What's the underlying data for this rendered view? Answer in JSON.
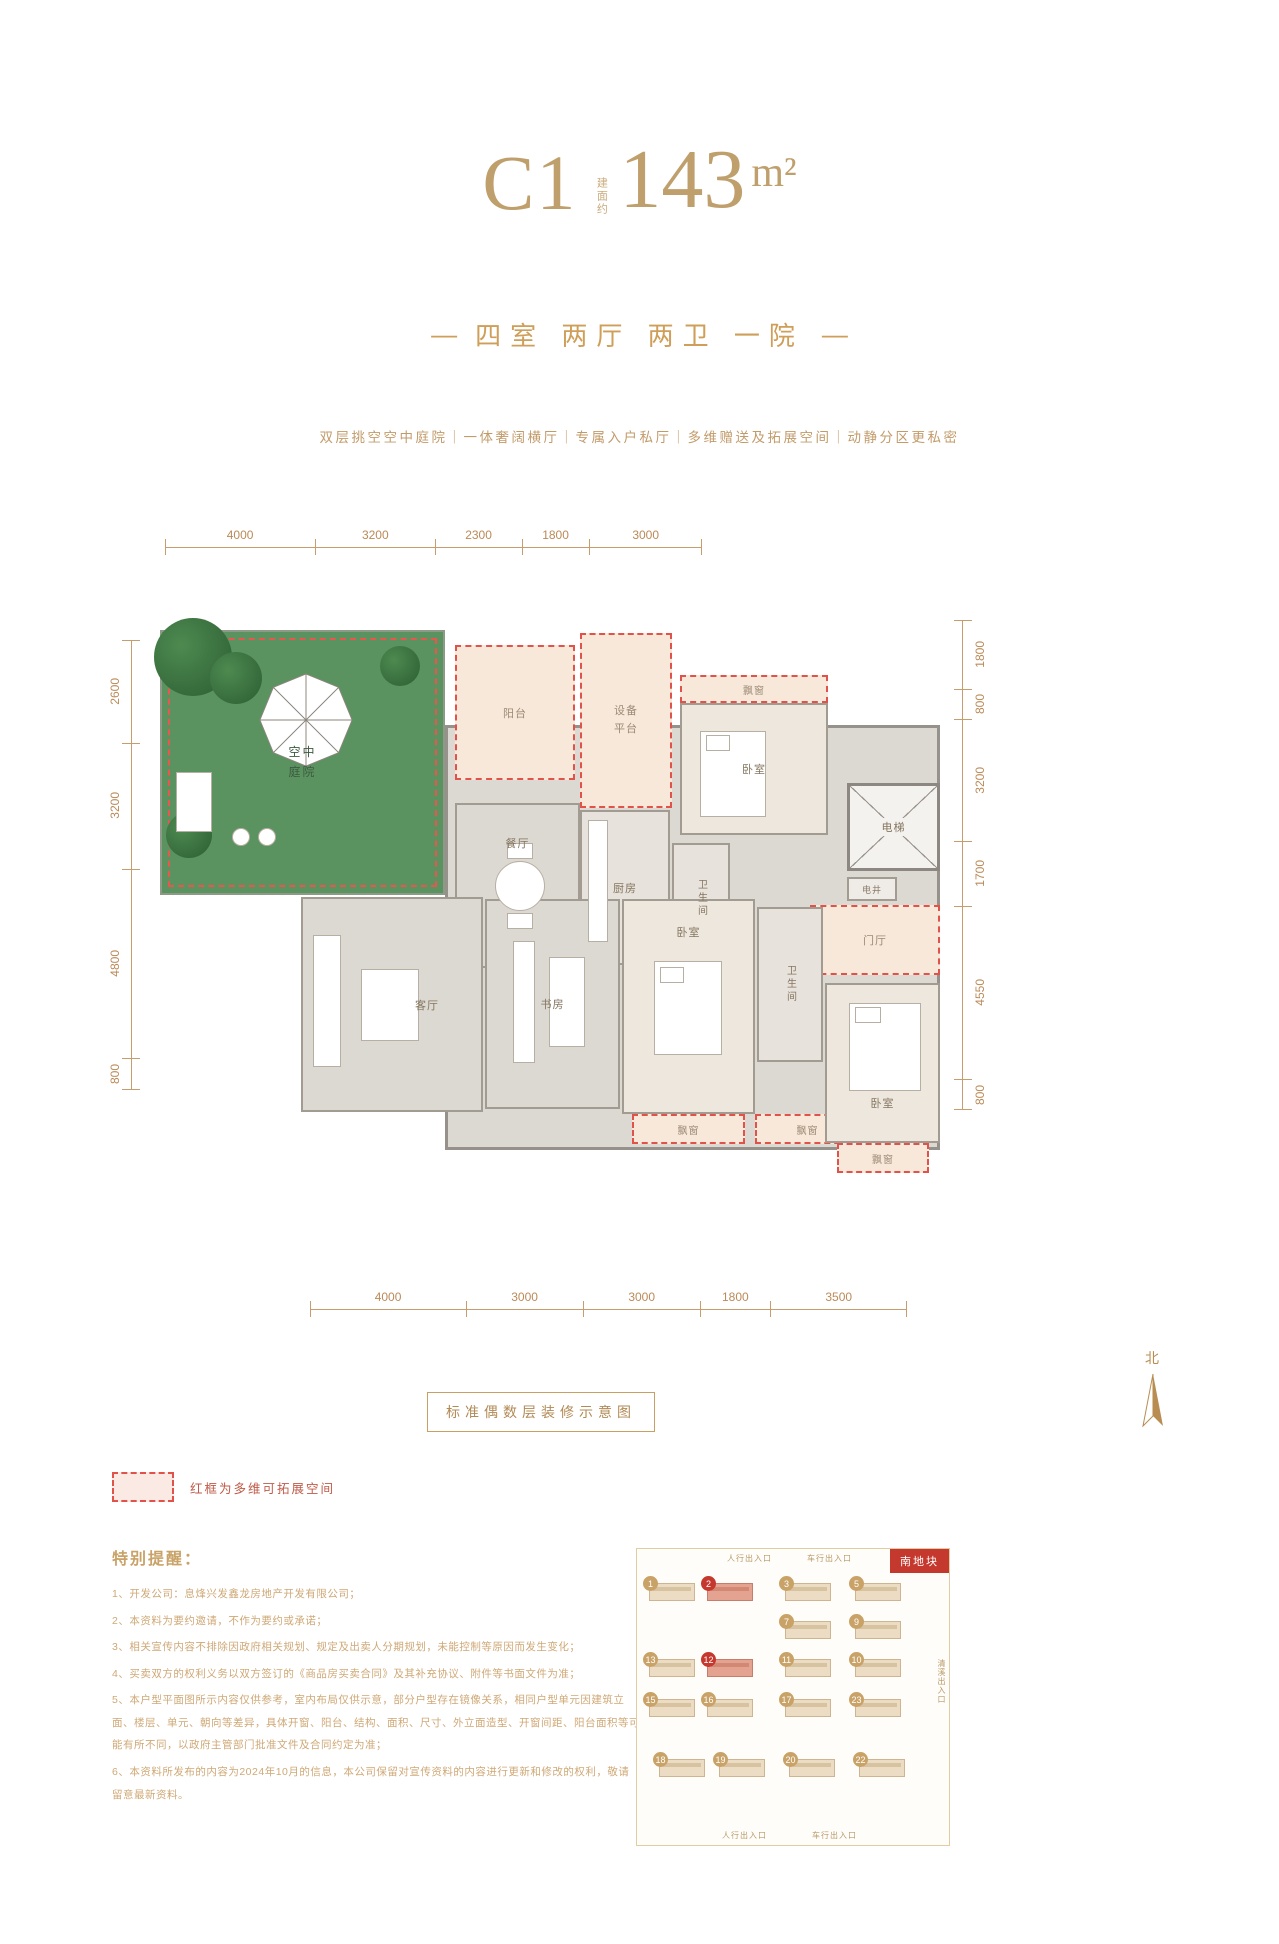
{
  "header": {
    "unit": "C1",
    "area_prefix": "建面约",
    "area": "143",
    "area_unit": "m²",
    "dash": "—",
    "subtitle": "四室 两厅 两卫 一院",
    "features": "双层挑空空中庭院｜一体奢阔横厅｜专属入户私厅｜多维赠送及拓展空间｜动静分区更私密"
  },
  "plan": {
    "caption": "标准偶数层装修示意图",
    "north_label": "北",
    "dims": {
      "top": [
        "4000",
        "3200",
        "2300",
        "1800",
        "3000"
      ],
      "left": [
        "2600",
        "3200",
        "4800",
        "800"
      ],
      "right": [
        "1800",
        "800",
        "3200",
        "1700",
        "4550",
        "800"
      ],
      "bottom": [
        "4000",
        "3000",
        "3000",
        "1800",
        "3500"
      ]
    },
    "rooms": {
      "courtyard": "空中庭院",
      "balcony": "阳台",
      "equipment": "设备平台",
      "bedroom1": "卧室",
      "bay1": "飘窗",
      "elevator": "电梯",
      "shaft": "电井",
      "foyer": "门厅",
      "dining": "餐厅",
      "kitchen": "厨房",
      "bath1": "卫生间",
      "living": "客厅",
      "study": "书房",
      "bedroom2": "卧室",
      "bay2": "飘窗",
      "bay4": "飘窗",
      "bath2": "卫生间",
      "bedroom3": "卧室",
      "bay3": "飘窗"
    }
  },
  "legend": {
    "text": "红框为多维可拓展空间"
  },
  "notes": {
    "title": "特别提醒：",
    "items": [
      "1、开发公司：息烽兴发鑫龙房地产开发有限公司；",
      "2、本资料为要约邀请，不作为要约或承诺；",
      "3、相关宣传内容不排除因政府相关规划、规定及出卖人分期规划，未能控制等原因而发生变化；",
      "4、买卖双方的权利义务以双方签订的《商品房买卖合同》及其补充协议、附件等书面文件为准；",
      "5、本户型平面图所示内容仅供参考，室内布局仅供示意，部分户型存在镜像关系，相同户型单元因建筑立面、楼层、单元、朝向等差异，具体开窗、阳台、结构、面积、尺寸、外立面造型、开窗间距、阳台面积等可能有所不同，以政府主管部门批准文件及合同约定为准；",
      "6、本资料所发布的内容为2024年10月的信息，本公司保留对宣传资料的内容进行更新和修改的权利，敬请留意最新资料。"
    ]
  },
  "siteplan": {
    "plot_label": "南地块",
    "entrances": {
      "top_left": "人行出入口",
      "top_right": "车行出入口",
      "right": "清溪出入口",
      "bottom_left": "人行出入口",
      "bottom_right": "车行出入口"
    },
    "rows": [
      [
        "1",
        "2",
        "3",
        "5"
      ],
      [
        "7",
        "9"
      ],
      [
        "13",
        "12",
        "11",
        "10"
      ],
      [
        "15",
        "16",
        "17",
        "23"
      ],
      [
        "18",
        "19",
        "20",
        "22"
      ]
    ],
    "highlighted": [
      "2",
      "12"
    ]
  },
  "colors": {
    "gold": "#bf9f6c",
    "dim_brown": "#bb8a58",
    "red_dash": "#e0524a",
    "grass_green": "#5b9360",
    "cream": "#f8e8da",
    "tag_red": "#c5382e"
  }
}
